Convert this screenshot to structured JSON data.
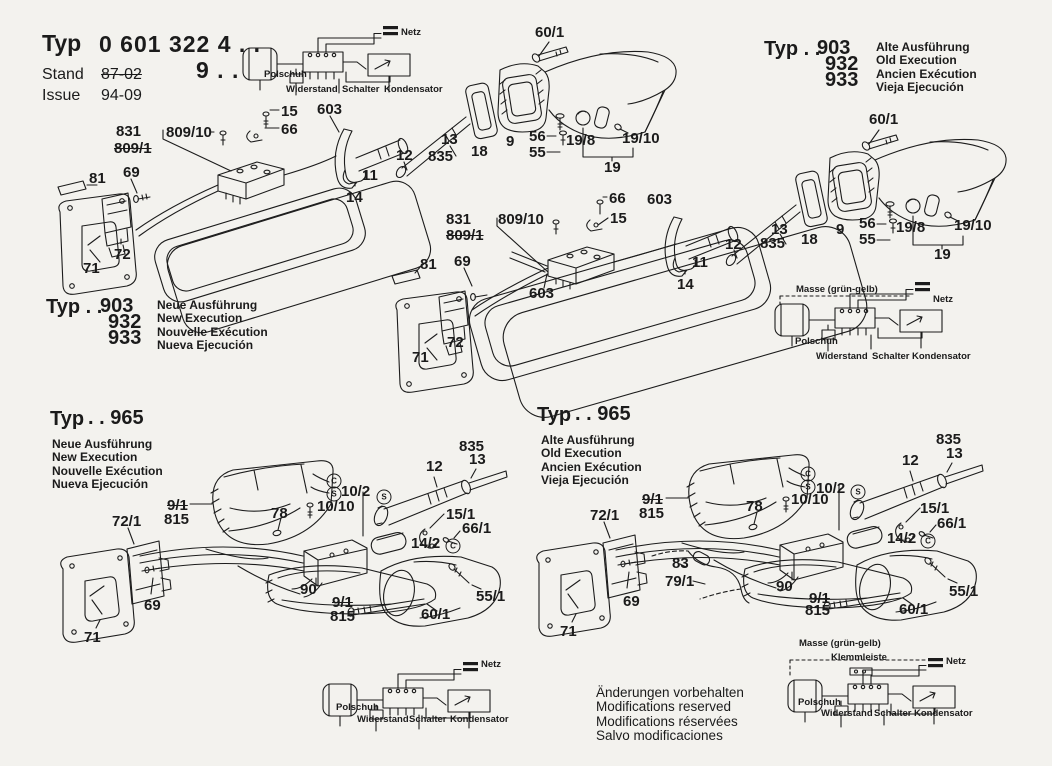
{
  "title_block": {
    "typ_label": "Typ",
    "typ_value": "0 601 322 4 . .",
    "typ_value2": "9 . .",
    "stand_label": "Stand",
    "stand_value": "87-02",
    "issue_label": "Issue",
    "issue_value": "94-09"
  },
  "type_blocks": {
    "top_right": {
      "typ": "Typ . .",
      "codes": [
        "903",
        "932",
        "933"
      ],
      "variants": [
        "Alte Ausführung",
        "Old Execution",
        "Ancien Exécution",
        "Vieja Ejecución"
      ]
    },
    "mid_left": {
      "typ": "Typ . .",
      "codes": [
        "903",
        "932",
        "933"
      ],
      "variants": [
        "Neue Ausführung",
        "New Execution",
        "Nouvelle Exécution",
        "Nueva Ejecución"
      ]
    },
    "bottom_left": {
      "typ": "Typ",
      "code": ". . 965",
      "variants": [
        "Neue Ausführung",
        "New Execution",
        "Nouvelle Exécution",
        "Nueva Ejecución"
      ]
    },
    "bottom_mid": {
      "typ": "Typ",
      "code": ". . 965",
      "variants": [
        "Alte Ausführung",
        "Old Execution",
        "Ancien Exécution",
        "Vieja Ejecución"
      ]
    }
  },
  "wiring": {
    "top": {
      "netz": "Netz",
      "polschuh": "Polschuh",
      "widerstand": "Widerstand",
      "schalter": "Schalter",
      "kondensator": "Kondensator"
    },
    "mid_right": {
      "masse": "Masse (grün-gelb)",
      "netz": "Netz",
      "polschuh": "Polschuh",
      "widerstand": "Widerstand",
      "schalter": "Schalter",
      "kondensator": "Kondensator"
    },
    "bottom_center": {
      "netz": "Netz",
      "polschuh": "Polschuh",
      "widerstand": "Widerstand",
      "schalter": "Schalter",
      "kondensator": "Kondensator"
    },
    "bottom_right": {
      "masse": "Masse (grün-gelb)",
      "klemmleiste": "Klemmleiste",
      "netz": "Netz",
      "polschuh": "Polschuh",
      "widerstand": "Widerstand",
      "schalter": "Schalter",
      "kondensator": "Kondensator"
    }
  },
  "footer": {
    "lines": [
      "Änderungen vorbehalten",
      "Modifications reserved",
      "Modifications réservées",
      "Salvo modificaciones"
    ]
  },
  "part_labels": [
    {
      "t": "831",
      "x": 116,
      "y": 124
    },
    {
      "t": "809/1",
      "x": 114,
      "y": 141,
      "struck": 1
    },
    {
      "t": "809/10",
      "x": 166,
      "y": 125
    },
    {
      "t": "15",
      "x": 281,
      "y": 104
    },
    {
      "t": "66",
      "x": 281,
      "y": 122
    },
    {
      "t": "603",
      "x": 317,
      "y": 102
    },
    {
      "t": "81",
      "x": 89,
      "y": 171
    },
    {
      "t": "69",
      "x": 123,
      "y": 165
    },
    {
      "t": "72",
      "x": 114,
      "y": 247
    },
    {
      "t": "71",
      "x": 83,
      "y": 261
    },
    {
      "t": "60/1",
      "x": 535,
      "y": 25
    },
    {
      "t": "12",
      "x": 396,
      "y": 148
    },
    {
      "t": "13",
      "x": 441,
      "y": 132
    },
    {
      "t": "835",
      "x": 428,
      "y": 149
    },
    {
      "t": "18",
      "x": 471,
      "y": 144
    },
    {
      "t": "9",
      "x": 506,
      "y": 134
    },
    {
      "t": "56",
      "x": 529,
      "y": 129
    },
    {
      "t": "55",
      "x": 529,
      "y": 145
    },
    {
      "t": "19/8",
      "x": 566,
      "y": 133
    },
    {
      "t": "19/10",
      "x": 622,
      "y": 131
    },
    {
      "t": "19",
      "x": 604,
      "y": 160
    },
    {
      "t": "11",
      "x": 362,
      "y": 168
    },
    {
      "t": "14",
      "x": 346,
      "y": 190
    },
    {
      "t": "60/1",
      "x": 869,
      "y": 112
    },
    {
      "t": "12",
      "x": 725,
      "y": 237
    },
    {
      "t": "13",
      "x": 771,
      "y": 222
    },
    {
      "t": "835",
      "x": 760,
      "y": 236
    },
    {
      "t": "18",
      "x": 801,
      "y": 232
    },
    {
      "t": "9",
      "x": 836,
      "y": 222
    },
    {
      "t": "56",
      "x": 859,
      "y": 216
    },
    {
      "t": "55",
      "x": 859,
      "y": 232
    },
    {
      "t": "19/8",
      "x": 896,
      "y": 220
    },
    {
      "t": "19/10",
      "x": 954,
      "y": 218
    },
    {
      "t": "19",
      "x": 934,
      "y": 247
    },
    {
      "t": "11",
      "x": 692,
      "y": 255
    },
    {
      "t": "14",
      "x": 677,
      "y": 277
    },
    {
      "t": "603",
      "x": 647,
      "y": 192
    },
    {
      "t": "66",
      "x": 609,
      "y": 191
    },
    {
      "t": "15",
      "x": 610,
      "y": 211
    },
    {
      "t": "831",
      "x": 446,
      "y": 212
    },
    {
      "t": "809/1",
      "x": 446,
      "y": 228,
      "struck": 1
    },
    {
      "t": "809/10",
      "x": 498,
      "y": 212
    },
    {
      "t": "81",
      "x": 420,
      "y": 257
    },
    {
      "t": "69",
      "x": 454,
      "y": 254
    },
    {
      "t": "603",
      "x": 529,
      "y": 286
    },
    {
      "t": "72",
      "x": 447,
      "y": 335
    },
    {
      "t": "71",
      "x": 412,
      "y": 350
    },
    {
      "t": "835",
      "x": 459,
      "y": 439
    },
    {
      "t": "13",
      "x": 469,
      "y": 452
    },
    {
      "t": "12",
      "x": 426,
      "y": 459
    },
    {
      "t": "10/2",
      "x": 341,
      "y": 484
    },
    {
      "t": "10/10",
      "x": 317,
      "y": 499
    },
    {
      "t": "78",
      "x": 271,
      "y": 506
    },
    {
      "t": "9/1",
      "x": 167,
      "y": 498,
      "struck": 1
    },
    {
      "t": "815",
      "x": 164,
      "y": 512
    },
    {
      "t": "72/1",
      "x": 112,
      "y": 514
    },
    {
      "t": "15/1",
      "x": 446,
      "y": 507
    },
    {
      "t": "66/1",
      "x": 462,
      "y": 521
    },
    {
      "t": "14/2",
      "x": 411,
      "y": 536
    },
    {
      "t": "90",
      "x": 300,
      "y": 582
    },
    {
      "t": "9/1",
      "x": 332,
      "y": 595,
      "struck": 1
    },
    {
      "t": "815",
      "x": 330,
      "y": 609
    },
    {
      "t": "60/1",
      "x": 421,
      "y": 607
    },
    {
      "t": "55/1",
      "x": 476,
      "y": 589
    },
    {
      "t": "69",
      "x": 144,
      "y": 598
    },
    {
      "t": "71",
      "x": 84,
      "y": 630
    },
    {
      "t": "C",
      "x": 334,
      "y": 481,
      "circ": 1
    },
    {
      "t": "S",
      "x": 334,
      "y": 494,
      "circ": 1
    },
    {
      "t": "S",
      "x": 384,
      "y": 497,
      "circ": 1
    },
    {
      "t": "C",
      "x": 453,
      "y": 546,
      "circ": 1
    },
    {
      "t": "835",
      "x": 936,
      "y": 432
    },
    {
      "t": "13",
      "x": 946,
      "y": 446
    },
    {
      "t": "12",
      "x": 902,
      "y": 453
    },
    {
      "t": "10/2",
      "x": 816,
      "y": 481
    },
    {
      "t": "10/10",
      "x": 791,
      "y": 492
    },
    {
      "t": "78",
      "x": 746,
      "y": 499
    },
    {
      "t": "9/1",
      "x": 642,
      "y": 492,
      "struck": 1
    },
    {
      "t": "815",
      "x": 639,
      "y": 506
    },
    {
      "t": "72/1",
      "x": 590,
      "y": 508
    },
    {
      "t": "15/1",
      "x": 920,
      "y": 501
    },
    {
      "t": "66/1",
      "x": 937,
      "y": 516
    },
    {
      "t": "14/2",
      "x": 887,
      "y": 531
    },
    {
      "t": "83",
      "x": 672,
      "y": 556
    },
    {
      "t": "79/1",
      "x": 665,
      "y": 574
    },
    {
      "t": "90",
      "x": 776,
      "y": 579
    },
    {
      "t": "9/1",
      "x": 809,
      "y": 591,
      "struck": 1
    },
    {
      "t": "815",
      "x": 805,
      "y": 603
    },
    {
      "t": "60/1",
      "x": 899,
      "y": 602
    },
    {
      "t": "55/1",
      "x": 949,
      "y": 584
    },
    {
      "t": "69",
      "x": 623,
      "y": 594
    },
    {
      "t": "71",
      "x": 560,
      "y": 624
    },
    {
      "t": "C",
      "x": 808,
      "y": 474,
      "circ": 1
    },
    {
      "t": "S",
      "x": 808,
      "y": 487,
      "circ": 1
    },
    {
      "t": "S",
      "x": 858,
      "y": 492,
      "circ": 1
    },
    {
      "t": "C",
      "x": 928,
      "y": 541,
      "circ": 1
    }
  ]
}
